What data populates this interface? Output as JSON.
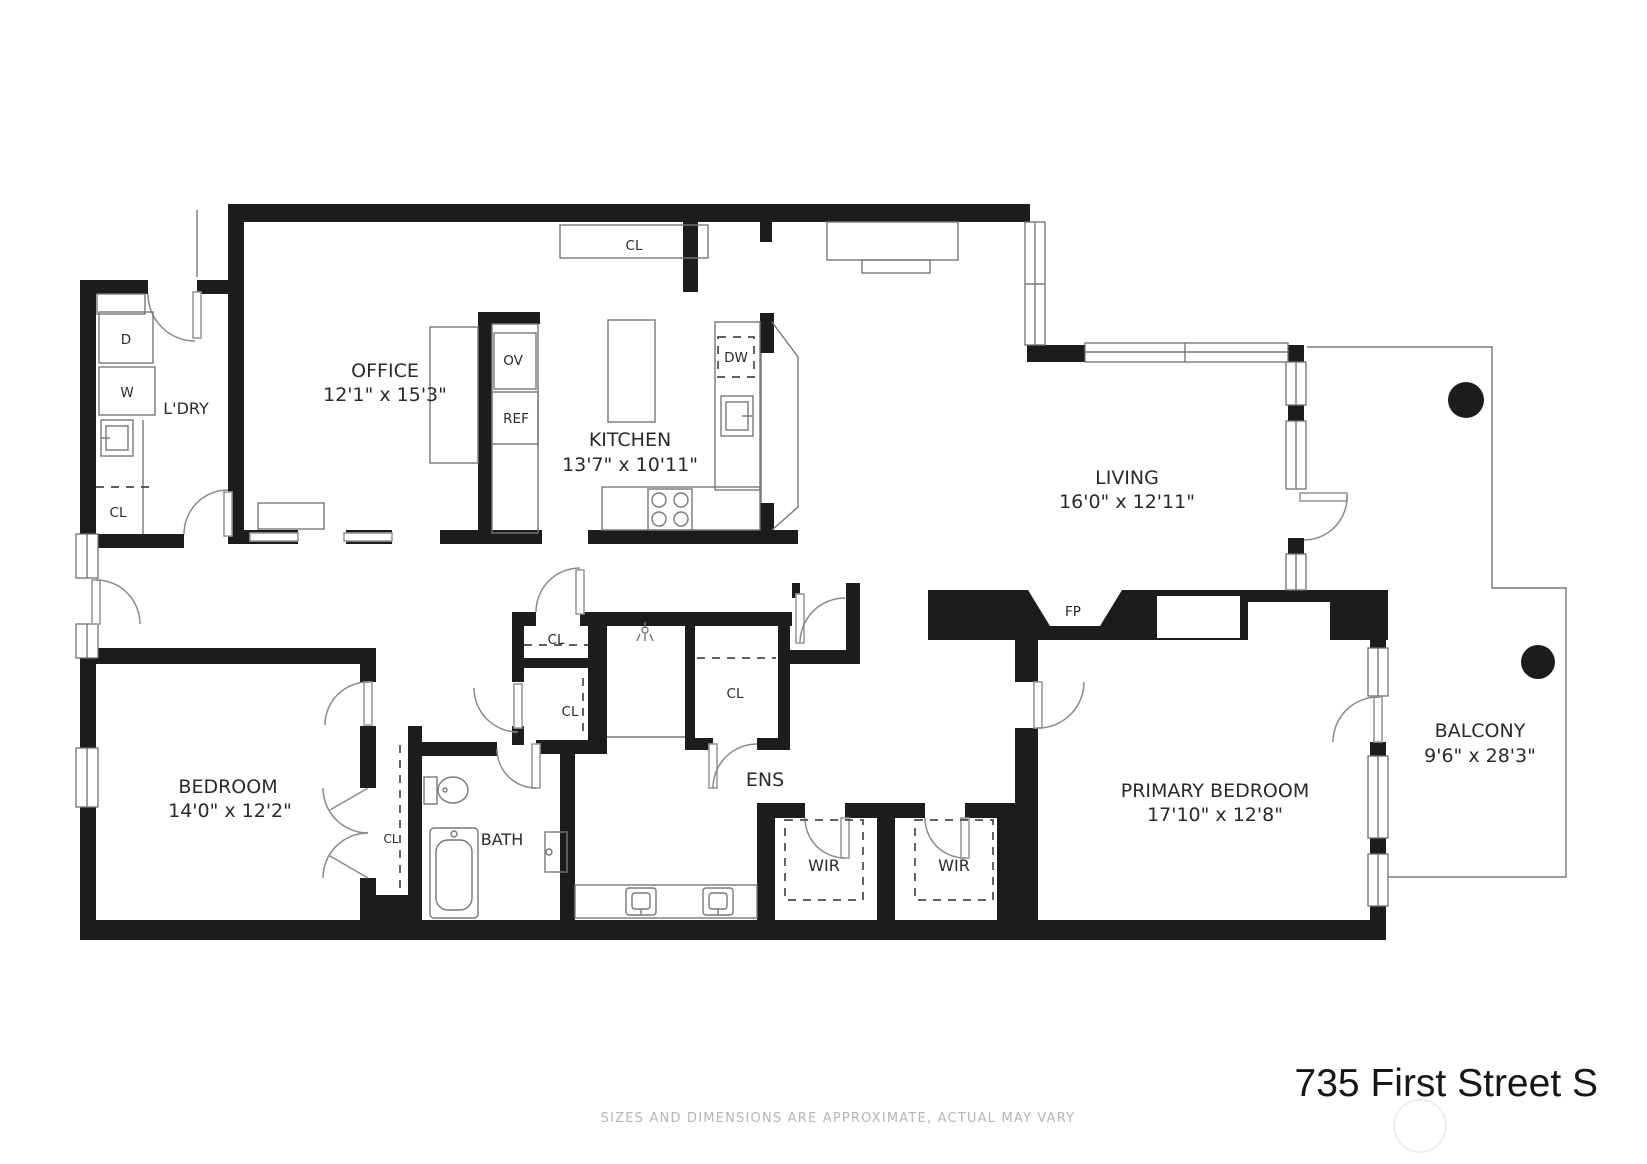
{
  "title": "735 First Street S",
  "disclaimer": "SIZES AND DIMENSIONS ARE APPROXIMATE, ACTUAL MAY VARY",
  "rooms": {
    "office": {
      "name": "OFFICE",
      "dims": "12'1\" x 15'3\""
    },
    "kitchen": {
      "name": "KITCHEN",
      "dims": "13'7\" x 10'11\""
    },
    "living": {
      "name": "LIVING",
      "dims": "16'0\" x 12'11\""
    },
    "bedroom": {
      "name": "BEDROOM",
      "dims": "14'0\" x 12'2\""
    },
    "primary_bedroom": {
      "name": "PRIMARY BEDROOM",
      "dims": "17'10\" x 12'8\""
    },
    "balcony": {
      "name": "BALCONY",
      "dims": "9'6\" x 28'3\""
    },
    "laundry": {
      "name": "L'DRY"
    },
    "ensuite": {
      "name": "ENS"
    },
    "bath": {
      "name": "BATH"
    }
  },
  "labels": {
    "closet": "CL",
    "dishwasher": "DW",
    "oven": "OV",
    "refrigerator": "REF",
    "dryer": "D",
    "washer": "W",
    "fireplace": "FP",
    "walk_in_robe": "WIR"
  },
  "colors": {
    "wall": "#1c1c1c",
    "thin_line": "#787878",
    "text": "#2a2a2a",
    "muted_text": "#b5b5b5"
  }
}
